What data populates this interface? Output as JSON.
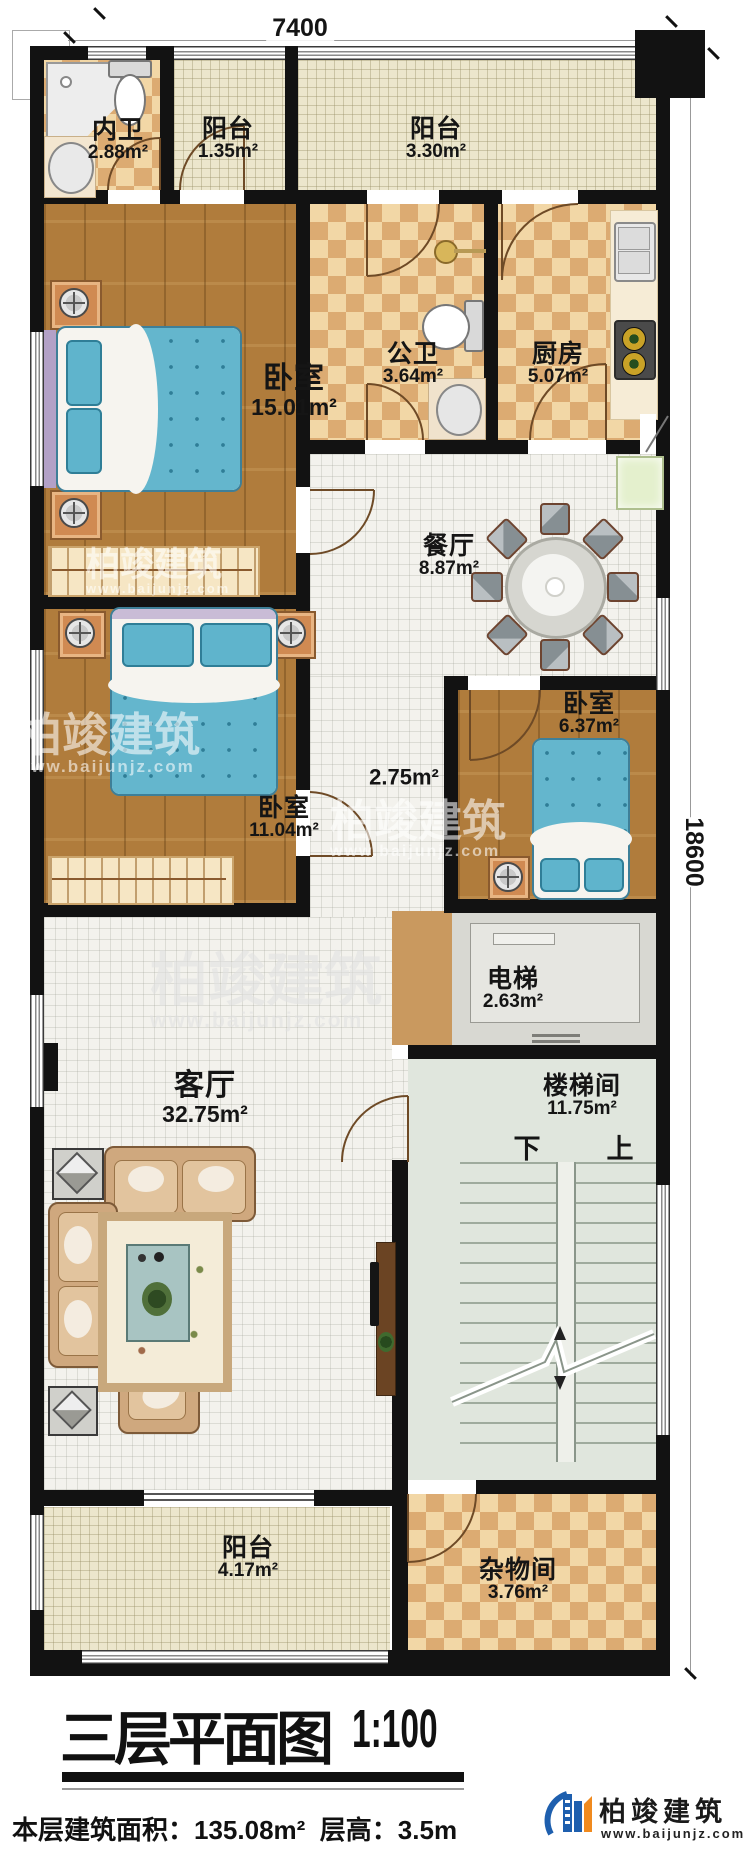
{
  "dimensions": {
    "top": "7400",
    "right": "18600"
  },
  "rooms": [
    {
      "name": "内卫",
      "area": "2.88m²"
    },
    {
      "name": "阳台",
      "area": "1.35m²"
    },
    {
      "name": "阳台",
      "area": "3.30m²"
    },
    {
      "name": "卧室",
      "area": "15.01m²"
    },
    {
      "name": "公卫",
      "area": "3.64m²"
    },
    {
      "name": "厨房",
      "area": "5.07m²"
    },
    {
      "name": "餐厅",
      "area": "8.87m²"
    },
    {
      "name": "卧室",
      "area": "6.37m²"
    },
    {
      "name": "",
      "area": "2.75m²"
    },
    {
      "name": "卧室",
      "area": "11.04m²"
    },
    {
      "name": "电梯",
      "area": "2.63m²"
    },
    {
      "name": "客厅",
      "area": "32.75m²"
    },
    {
      "name": "楼梯间",
      "area": "11.75m²"
    },
    {
      "name": "阳台",
      "area": "4.17m²"
    },
    {
      "name": "杂物间",
      "area": "3.76m²"
    }
  ],
  "stairs": {
    "down": "下",
    "up": "上"
  },
  "title": {
    "main": "三层平面图",
    "scale": "1:100"
  },
  "footer": {
    "area_label": "本层建筑面积：",
    "area_value": "135.08m²",
    "height_label": "层高：",
    "height_value": "3.5m"
  },
  "brand": {
    "name": "柏竣建筑",
    "url": "www.baijunjz.com"
  },
  "watermark": {
    "name": "柏竣建筑",
    "url": "www.baijunjz.com"
  }
}
